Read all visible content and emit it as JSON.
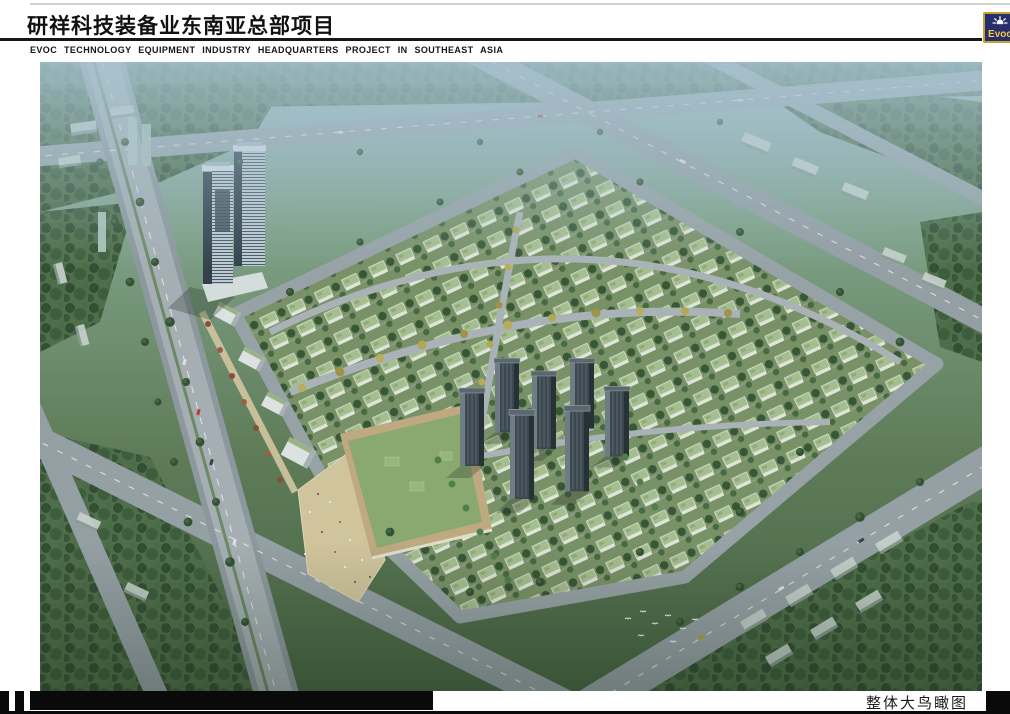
{
  "header": {
    "title_cn": "研祥科技装备业东南亚总部项目",
    "subtitle_en": "EVOC TECHNOLOGY EQUIPMENT INDUSTRY HEADQUARTERS PROJECT IN SOUTHEAST ASIA",
    "logo": {
      "text": "Evoc",
      "icon": "sunburst-icon",
      "bg_color": "#262f6e",
      "border_color": "#c7a12e",
      "text_color": "#f2c83c"
    }
  },
  "footer": {
    "caption": "整体大鸟瞰图"
  },
  "rendering": {
    "kind": "aerial-birdseye-architectural-rendering",
    "palette": {
      "haze_blue": "#a8c6d4",
      "foliage_dark": "#2f4c2c",
      "foliage_mid": "#3a5a34",
      "grass": "#7a9162",
      "road_gray": "#98a1a5",
      "villa_roof_green": "#a9c18d",
      "villa_wall": "#e8ebdf",
      "plaza_sand": "#d8c79b",
      "mall_roof": "#8cab6c",
      "tower_glass_dark": "#46545f",
      "tower_glass_light": "#c3ced5",
      "residential_tower": "#39434b",
      "autumn_tree": "#c0ae52",
      "red_tree": "#8a4a33"
    }
  }
}
